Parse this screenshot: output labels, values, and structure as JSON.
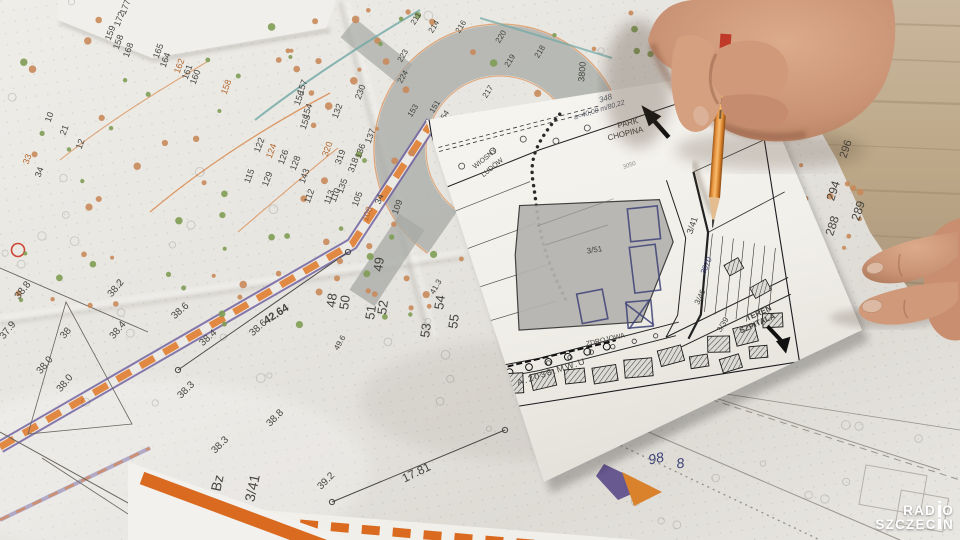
{
  "logo": {
    "line1": "RADIO",
    "line2": "SZCZECIN"
  },
  "colors": {
    "dark": "#45443f",
    "orange": "#b3682f",
    "ink": "#3d4277",
    "hand": "#5d6470",
    "faint": "#908e86",
    "road_orange": "#e07f35",
    "road_purple": "#6b5b9e",
    "stream_teal": "#6fa8a5",
    "pencil_orange": "#d9822b",
    "tree_green": "#7f9c54",
    "tree_orange": "#c98a5a"
  },
  "big_map": {
    "labels": [
      {
        "t": "177",
        "x": 128,
        "y": 8,
        "r": -70,
        "s": 9
      },
      {
        "t": "172",
        "x": 122,
        "y": 20,
        "r": -70,
        "s": 9
      },
      {
        "t": "159",
        "x": 113,
        "y": 34,
        "r": -70,
        "s": 9
      },
      {
        "t": "158",
        "x": 121,
        "y": 43,
        "r": -70,
        "s": 9
      },
      {
        "t": "168",
        "x": 131,
        "y": 51,
        "r": -70,
        "s": 9
      },
      {
        "t": "165",
        "x": 161,
        "y": 52,
        "r": -70,
        "s": 9
      },
      {
        "t": "164",
        "x": 168,
        "y": 61,
        "r": -70,
        "s": 9
      },
      {
        "t": "162",
        "x": 182,
        "y": 67,
        "r": -70,
        "s": 9,
        "c": "orange"
      },
      {
        "t": "161",
        "x": 190,
        "y": 73,
        "r": -70,
        "s": 9
      },
      {
        "t": "160",
        "x": 198,
        "y": 78,
        "r": -70,
        "s": 9
      },
      {
        "t": "158",
        "x": 229,
        "y": 88,
        "r": -70,
        "s": 9,
        "c": "orange"
      },
      {
        "t": "10",
        "x": 52,
        "y": 118,
        "r": -70,
        "s": 9
      },
      {
        "t": "21",
        "x": 67,
        "y": 131,
        "r": -70,
        "s": 9
      },
      {
        "t": "12",
        "x": 83,
        "y": 145,
        "r": -70,
        "s": 9
      },
      {
        "t": "33",
        "x": 30,
        "y": 160,
        "r": -70,
        "s": 9,
        "c": "orange"
      },
      {
        "t": "34",
        "x": 42,
        "y": 173,
        "r": -70,
        "s": 9
      },
      {
        "t": "157",
        "x": 305,
        "y": 88,
        "r": -70,
        "s": 9
      },
      {
        "t": "156",
        "x": 302,
        "y": 99,
        "r": -70,
        "s": 9
      },
      {
        "t": "154",
        "x": 310,
        "y": 112,
        "r": -70,
        "s": 9
      },
      {
        "t": "155",
        "x": 308,
        "y": 123,
        "r": -70,
        "s": 9
      },
      {
        "t": "132",
        "x": 340,
        "y": 112,
        "r": -70,
        "s": 9
      },
      {
        "t": "137",
        "x": 373,
        "y": 137,
        "r": -70,
        "s": 9
      },
      {
        "t": "136",
        "x": 363,
        "y": 152,
        "r": -70,
        "s": 9
      },
      {
        "t": "320",
        "x": 330,
        "y": 150,
        "r": -70,
        "s": 9,
        "c": "orange"
      },
      {
        "t": "319",
        "x": 343,
        "y": 158,
        "r": -70,
        "s": 9
      },
      {
        "t": "318",
        "x": 356,
        "y": 166,
        "r": -70,
        "s": 9
      },
      {
        "t": "135",
        "x": 345,
        "y": 187,
        "r": -70,
        "s": 9
      },
      {
        "t": "110",
        "x": 338,
        "y": 196,
        "r": -70,
        "s": 9
      },
      {
        "t": "105",
        "x": 360,
        "y": 200,
        "r": -70,
        "s": 9
      },
      {
        "t": "108",
        "x": 370,
        "y": 215,
        "r": -70,
        "s": 9,
        "c": "orange"
      },
      {
        "t": "34",
        "x": 382,
        "y": 200,
        "r": -70,
        "s": 9
      },
      {
        "t": "109",
        "x": 400,
        "y": 208,
        "r": -70,
        "s": 9
      },
      {
        "t": "112",
        "x": 312,
        "y": 197,
        "r": -70,
        "s": 9
      },
      {
        "t": "113",
        "x": 332,
        "y": 198,
        "r": -70,
        "s": 9
      },
      {
        "t": "115",
        "x": 252,
        "y": 177,
        "r": -70,
        "s": 9
      },
      {
        "t": "129",
        "x": 270,
        "y": 180,
        "r": -70,
        "s": 9
      },
      {
        "t": "143",
        "x": 307,
        "y": 177,
        "r": -70,
        "s": 9
      },
      {
        "t": "122",
        "x": 262,
        "y": 146,
        "r": -70,
        "s": 9
      },
      {
        "t": "124",
        "x": 274,
        "y": 152,
        "r": -70,
        "s": 9,
        "c": "orange"
      },
      {
        "t": "126",
        "x": 286,
        "y": 158,
        "r": -70,
        "s": 9
      },
      {
        "t": "128",
        "x": 298,
        "y": 164,
        "r": -70,
        "s": 9
      },
      {
        "t": "230",
        "x": 363,
        "y": 93,
        "r": -70,
        "s": 9
      },
      {
        "t": "223",
        "x": 405,
        "y": 57,
        "r": -60,
        "s": 8
      },
      {
        "t": "224",
        "x": 405,
        "y": 78,
        "r": -60,
        "s": 8
      },
      {
        "t": "211",
        "x": 418,
        "y": 20,
        "r": -58,
        "s": 8
      },
      {
        "t": "214",
        "x": 436,
        "y": 28,
        "r": -58,
        "s": 8
      },
      {
        "t": "216",
        "x": 463,
        "y": 28,
        "r": -58,
        "s": 8
      },
      {
        "t": "220",
        "x": 503,
        "y": 38,
        "r": -58,
        "s": 8
      },
      {
        "t": "218",
        "x": 542,
        "y": 53,
        "r": -58,
        "s": 8
      },
      {
        "t": "219",
        "x": 512,
        "y": 62,
        "r": -58,
        "s": 8
      },
      {
        "t": "217",
        "x": 490,
        "y": 93,
        "r": -58,
        "s": 8
      },
      {
        "t": "153",
        "x": 415,
        "y": 112,
        "r": -58,
        "s": 8
      },
      {
        "t": "151",
        "x": 437,
        "y": 108,
        "r": -58,
        "s": 8
      },
      {
        "t": "154",
        "x": 446,
        "y": 118,
        "r": -58,
        "s": 8
      },
      {
        "t": "49",
        "x": 383,
        "y": 265,
        "r": -82,
        "s": 13
      },
      {
        "t": "48",
        "x": 336,
        "y": 301,
        "r": -82,
        "s": 13
      },
      {
        "t": "50",
        "x": 349,
        "y": 303,
        "r": -82,
        "s": 13
      },
      {
        "t": "51",
        "x": 375,
        "y": 313,
        "r": -82,
        "s": 13
      },
      {
        "t": "52",
        "x": 387,
        "y": 308,
        "r": -82,
        "s": 13
      },
      {
        "t": "53",
        "x": 430,
        "y": 331,
        "r": -82,
        "s": 13
      },
      {
        "t": "54",
        "x": 444,
        "y": 303,
        "r": -82,
        "s": 13
      },
      {
        "t": "55",
        "x": 458,
        "y": 322,
        "r": -82,
        "s": 13
      },
      {
        "t": "41.3",
        "x": 438,
        "y": 288,
        "r": -60,
        "s": 8
      },
      {
        "t": "49.6",
        "x": 342,
        "y": 344,
        "r": -60,
        "s": 8
      },
      {
        "t": "38.8",
        "x": 25,
        "y": 292,
        "r": -52,
        "s": 10
      },
      {
        "t": "37.9",
        "x": 10,
        "y": 332,
        "r": -52,
        "s": 10
      },
      {
        "t": "38.2",
        "x": 118,
        "y": 290,
        "r": -50,
        "s": 10
      },
      {
        "t": "38.4",
        "x": 120,
        "y": 332,
        "r": -50,
        "s": 10
      },
      {
        "t": "38",
        "x": 68,
        "y": 335,
        "r": -50,
        "s": 10
      },
      {
        "t": "38.0",
        "x": 47,
        "y": 367,
        "r": -50,
        "s": 10
      },
      {
        "t": "38.0",
        "x": 67,
        "y": 385,
        "r": -50,
        "s": 10
      },
      {
        "t": "38.6",
        "x": 182,
        "y": 313,
        "r": -42,
        "s": 10
      },
      {
        "t": "38.4",
        "x": 210,
        "y": 340,
        "r": -42,
        "s": 10
      },
      {
        "t": "38.6",
        "x": 260,
        "y": 330,
        "r": -42,
        "s": 10
      },
      {
        "t": "38.3",
        "x": 188,
        "y": 392,
        "r": -45,
        "s": 10
      },
      {
        "t": "38.8",
        "x": 277,
        "y": 420,
        "r": -45,
        "s": 10
      },
      {
        "t": "38.3",
        "x": 222,
        "y": 447,
        "r": -45,
        "s": 10
      },
      {
        "t": "39.2",
        "x": 328,
        "y": 483,
        "r": -45,
        "s": 10
      },
      {
        "t": "42.64",
        "x": 278,
        "y": 317,
        "r": -33,
        "s": 11,
        "b": 1
      },
      {
        "t": "17.81",
        "x": 418,
        "y": 476,
        "r": -26,
        "s": 12
      },
      {
        "t": "3/41",
        "x": 257,
        "y": 489,
        "r": -78,
        "s": 14
      },
      {
        "t": "Bz",
        "x": 222,
        "y": 484,
        "r": -78,
        "s": 14
      },
      {
        "t": "3800",
        "x": 585,
        "y": 72,
        "r": -85,
        "s": 9
      },
      {
        "t": "342",
        "x": 688,
        "y": 95,
        "r": -75,
        "s": 9
      },
      {
        "t": "392",
        "x": 800,
        "y": 84,
        "r": -75,
        "s": 9
      },
      {
        "t": "390",
        "x": 806,
        "y": 102,
        "r": -75,
        "s": 9
      },
      {
        "t": "38",
        "x": 788,
        "y": 70,
        "r": -75,
        "s": 9
      },
      {
        "t": "33",
        "x": 795,
        "y": 116,
        "r": -75,
        "s": 9
      },
      {
        "t": "337/311",
        "x": 748,
        "y": 156,
        "r": -45,
        "s": 9
      },
      {
        "t": "295",
        "x": 756,
        "y": 176,
        "r": -72,
        "s": 11
      },
      {
        "t": "284",
        "x": 769,
        "y": 187,
        "r": -72,
        "s": 11,
        "c": "orange"
      },
      {
        "t": "294",
        "x": 837,
        "y": 192,
        "r": -72,
        "s": 12
      },
      {
        "t": "286",
        "x": 806,
        "y": 206,
        "r": -72,
        "s": 12,
        "c": "orange"
      },
      {
        "t": "287",
        "x": 798,
        "y": 215,
        "r": -72,
        "s": 11
      },
      {
        "t": "289",
        "x": 862,
        "y": 212,
        "r": -72,
        "s": 12
      },
      {
        "t": "288",
        "x": 836,
        "y": 227,
        "r": -72,
        "s": 12
      },
      {
        "t": "280",
        "x": 783,
        "y": 222,
        "r": -72,
        "s": 11
      },
      {
        "t": "278",
        "x": 792,
        "y": 234,
        "r": -72,
        "s": 11,
        "c": "orange"
      },
      {
        "t": "276",
        "x": 817,
        "y": 247,
        "r": -72,
        "s": 12
      },
      {
        "t": "282",
        "x": 758,
        "y": 204,
        "r": -72,
        "s": 11,
        "c": "orange"
      },
      {
        "t": "296",
        "x": 849,
        "y": 150,
        "r": -72,
        "s": 11
      },
      {
        "t": "236",
        "x": 846,
        "y": 42,
        "r": -80,
        "s": 10
      },
      {
        "t": "337",
        "x": 852,
        "y": 72,
        "r": -80,
        "s": 10
      },
      {
        "t": "311",
        "x": 857,
        "y": 100,
        "r": -80,
        "s": 10
      },
      {
        "t": "98",
        "x": 657,
        "y": 463,
        "r": -12,
        "s": 14,
        "c": "ink"
      },
      {
        "t": "8",
        "x": 681,
        "y": 468,
        "r": -8,
        "s": 14,
        "c": "ink"
      }
    ]
  },
  "small_map": {
    "labels": [
      {
        "t": "PARK",
        "x": 186,
        "y": 30,
        "r": -5,
        "s": 8
      },
      {
        "t": "CHOPINA",
        "x": 182,
        "y": 40,
        "r": -5,
        "s": 8
      },
      {
        "t": "WIOSNY",
        "x": 40,
        "y": 42,
        "r": -30,
        "s": 7
      },
      {
        "t": "LUDÓW",
        "x": 46,
        "y": 52,
        "r": -30,
        "s": 7
      },
      {
        "t": "3050",
        "x": 181,
        "y": 71,
        "r": -10,
        "s": 6,
        "c": "faint"
      },
      {
        "t": "3/51",
        "x": 133,
        "y": 150,
        "r": 0,
        "s": 8
      },
      {
        "t": "3/41",
        "x": 236,
        "y": 140,
        "r": -62,
        "s": 9
      },
      {
        "t": "3/46",
        "x": 232,
        "y": 212,
        "r": -55,
        "s": 8
      },
      {
        "t": "3/39",
        "x": 250,
        "y": 243,
        "r": -50,
        "s": 8
      },
      {
        "t": "3870",
        "x": 243,
        "y": 182,
        "r": -58,
        "s": 8,
        "c": "ink"
      },
      {
        "t": "ZDROJOWA",
        "x": 130,
        "y": 240,
        "r": -4,
        "s": 7
      },
      {
        "t": "A.2038.MW.U",
        "x": 72,
        "y": 264,
        "r": -9,
        "s": 9,
        "ls": 1.5
      },
      {
        "t": "TEREN",
        "x": 286,
        "y": 238,
        "r": -15,
        "s": 8,
        "b": 1
      },
      {
        "t": "SZPITALA",
        "x": 283,
        "y": 248,
        "r": -15,
        "s": 8,
        "b": 1
      },
      {
        "t": "BUDYNEK C",
        "x": 270,
        "y": 10,
        "r": 78,
        "s": 7
      },
      {
        "t": "Ø40",
        "x": 255,
        "y": 36,
        "r": 70,
        "s": 7
      },
      {
        "t": "348",
        "x": 168,
        "y": 2,
        "r": -8,
        "s": 8,
        "c": "hand"
      },
      {
        "t": "a=40,00 m/80,22",
        "x": 160,
        "y": 12,
        "r": -8,
        "s": 7,
        "c": "hand"
      }
    ]
  }
}
